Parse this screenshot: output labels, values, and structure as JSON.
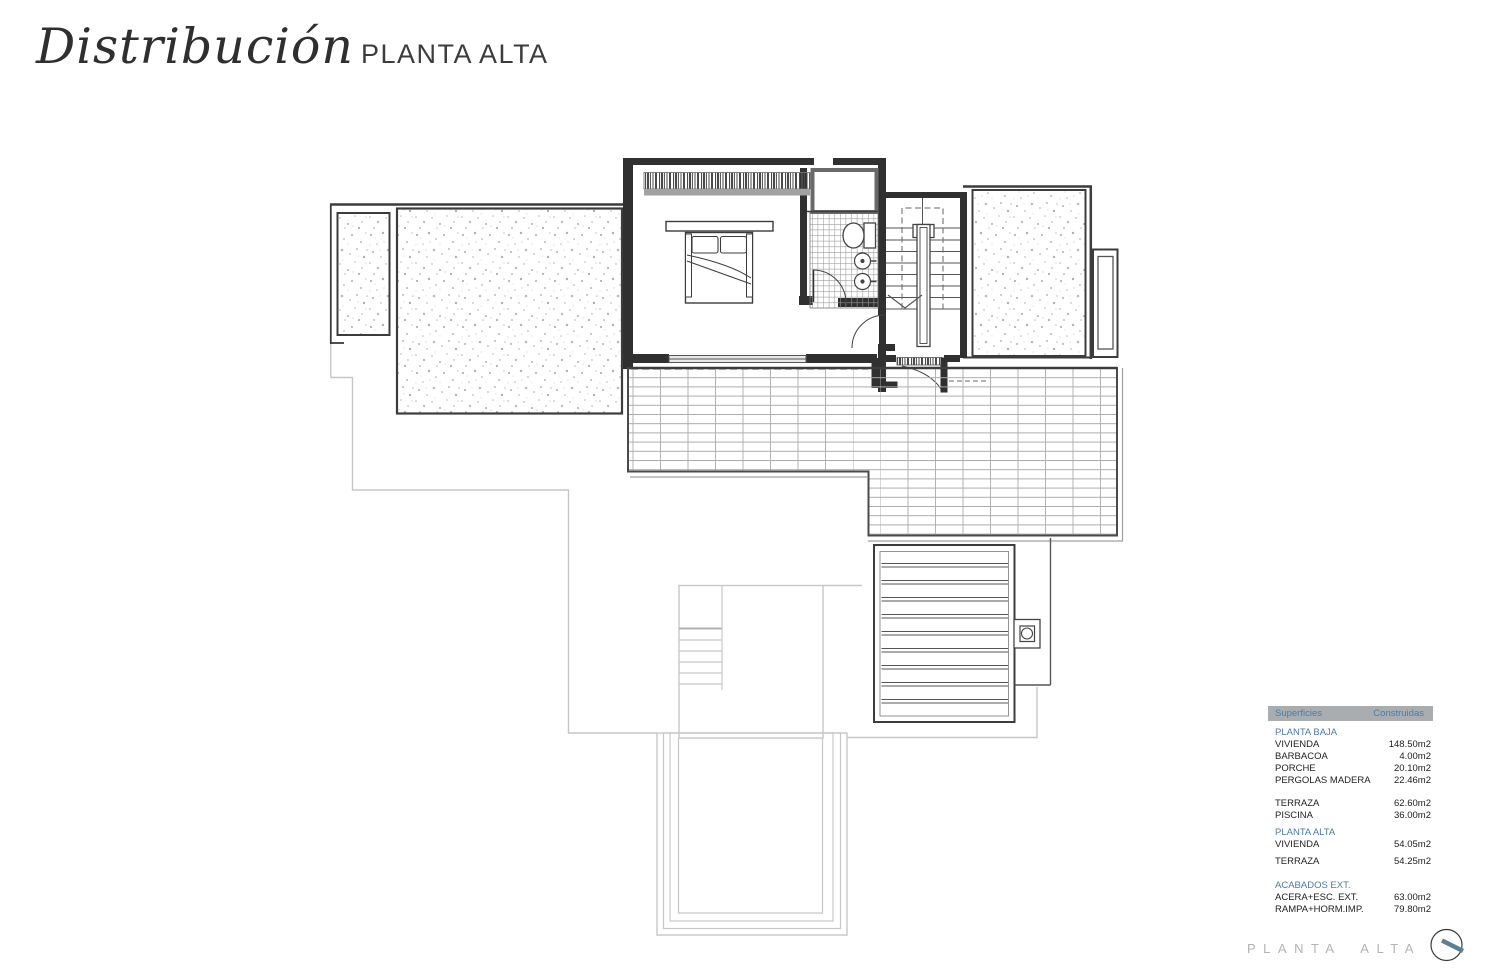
{
  "header": {
    "title_script": "Distribución",
    "title_caps": "PLANTA ALTA"
  },
  "table": {
    "col_headers": [
      "Superficies",
      "Construidas"
    ],
    "sections": [
      {
        "header": "PLANTA BAJA",
        "rows": [
          {
            "label": "VIVIENDA",
            "value": "148.50m2"
          },
          {
            "label": "BARBACOA",
            "value": "4.00m2"
          },
          {
            "label": "PORCHE",
            "value": "20.10m2"
          },
          {
            "label": "PERGOLAS MADERA",
            "value": "22.46m2"
          }
        ]
      },
      {
        "header": "",
        "rows": [
          {
            "label": "TERRAZA",
            "value": "62.60m2"
          },
          {
            "label": "PISCINA",
            "value": "36.00m2"
          }
        ]
      },
      {
        "header": "PLANTA ALTA",
        "rows": [
          {
            "label": "VIVIENDA",
            "value": "54.05m2"
          }
        ]
      },
      {
        "header": "",
        "rows": [
          {
            "label": "TERRAZA",
            "value": "54.25m2"
          }
        ]
      },
      {
        "header": "ACABADOS EXT.",
        "rows": [
          {
            "label": "ACERA+ESC. EXT.",
            "value": "63.00m2"
          },
          {
            "label": "RAMPA+HORM.IMP.",
            "value": "79.80m2"
          }
        ]
      }
    ]
  },
  "footer": {
    "label": "PLANTA ALTA"
  },
  "colors": {
    "accent_blue": "#4d7aa9",
    "table_header_bg": "#a9adb0",
    "footer_gray": "#b4b4b4",
    "compass_needle": "#5e7f93",
    "ink": "#2f2f2f"
  }
}
